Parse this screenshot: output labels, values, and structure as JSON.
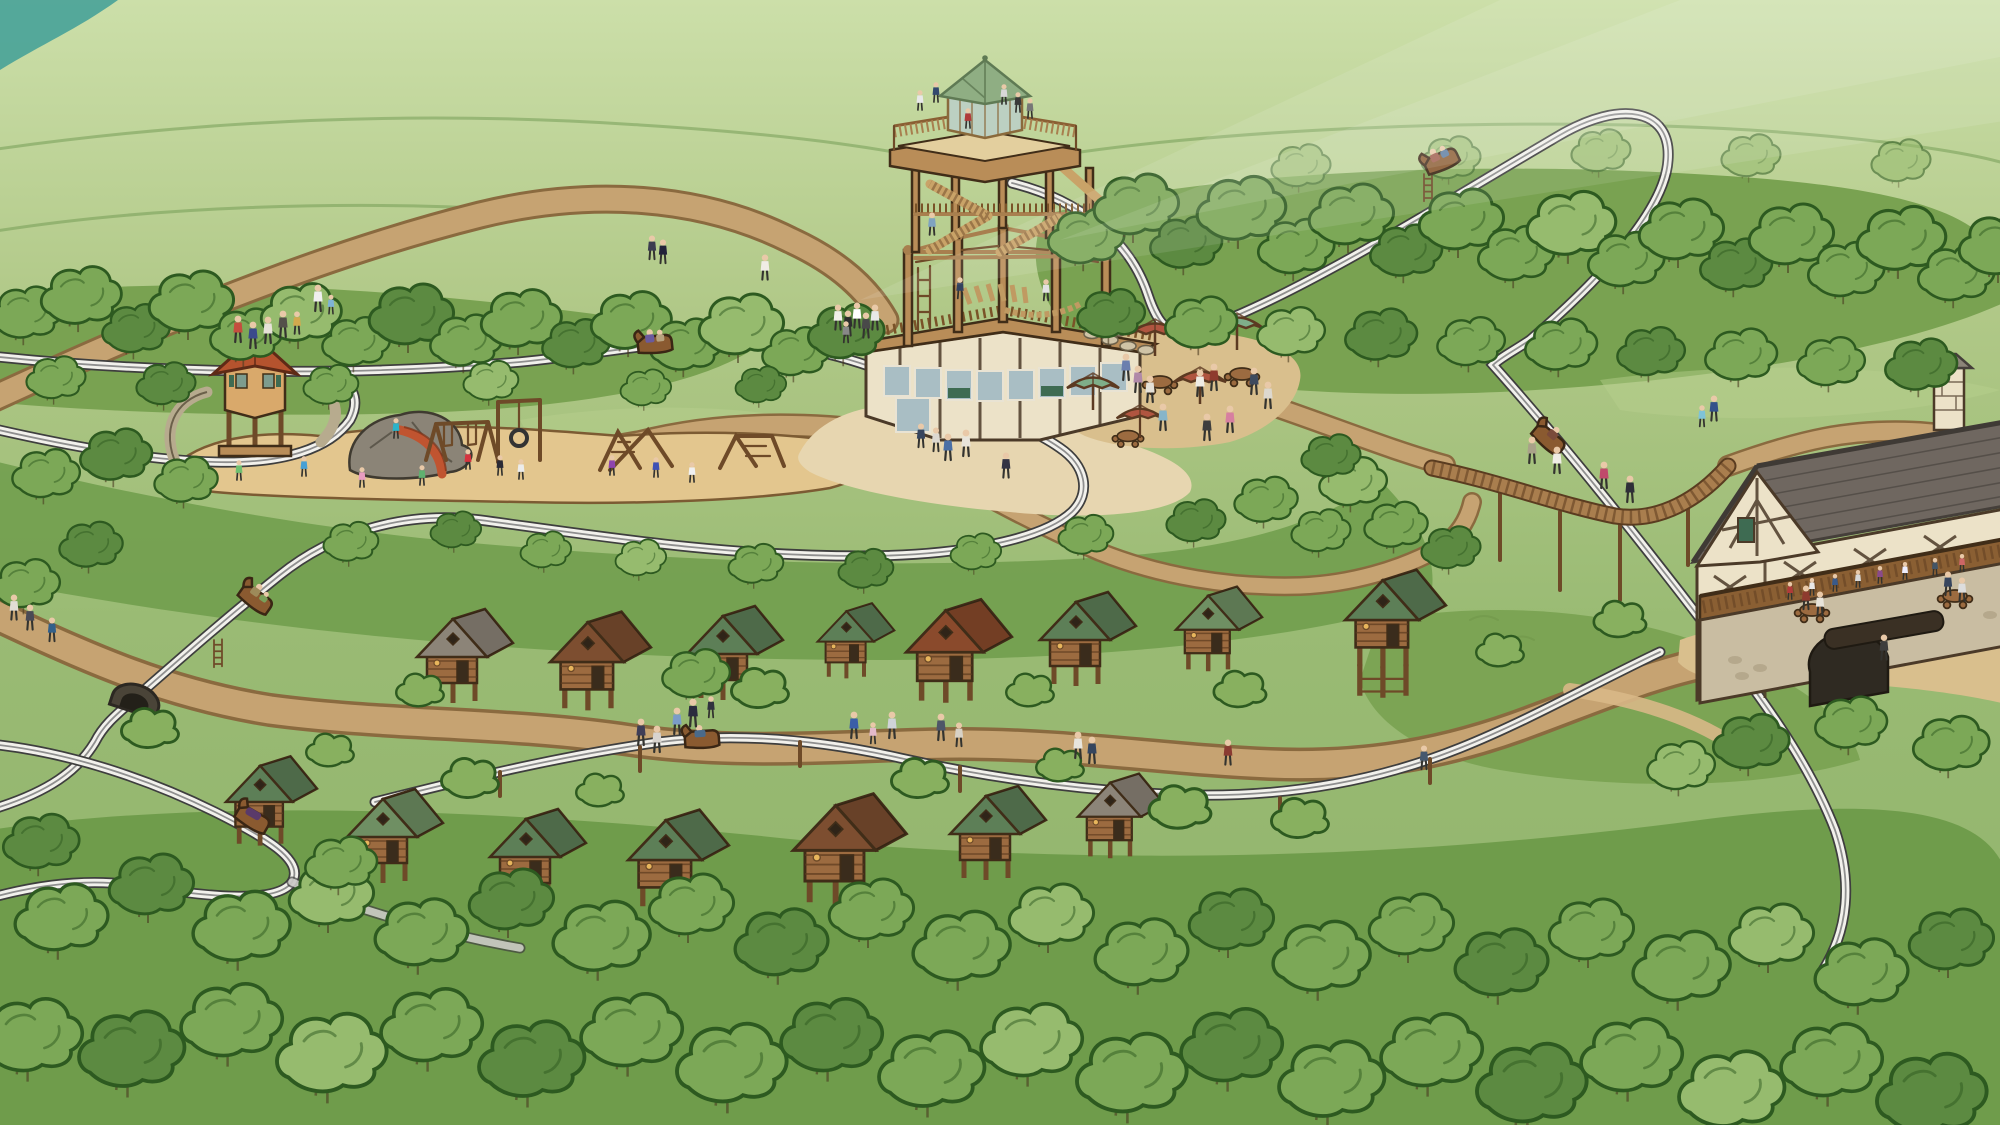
{
  "meta": {
    "title": "Illustrated forest adventure park map",
    "description": "Hand-drawn aerial map of a wooded family resort with an adventure tower, alpine coaster, stilted treehouse cabins, playground, umbrella patio and a half-timbered lodge."
  },
  "palette": {
    "bgTop": "#ccdfa9",
    "bgMid": "#b0c887",
    "bgLow": "#8fb26a",
    "teal": "#3f9f98",
    "ridge": "#6d9750",
    "forestMass": "#79a251",
    "forestFloor": "#6f9c4b",
    "grassLight": "#b7d08d",
    "tree": "#7ca857",
    "treeLight": "#96bb6e",
    "treeDark": "#5c8a41",
    "treeLine": "#2d5a20",
    "path": "#c6a372",
    "pathEdge": "#8a6a3f",
    "sand": "#e3c68e",
    "plaza": "#e7d6b0",
    "patioTan": "#d9bf8d",
    "trackDark": "#3e3e3e",
    "trackLight": "#f2f1ec",
    "trackMid": "#8f8f8f",
    "wood": "#b98d58",
    "woodMid": "#a87f4e",
    "woodDark": "#6e4a28",
    "woodLine": "#402d18",
    "logWall": "#9c6b40",
    "logLine": "#5d3a1e",
    "roofGreen": "#5d7f57",
    "roofGreen2": "#6f8f63",
    "roofBrown": "#7d4e30",
    "roofRust": "#8a4a2c",
    "roofGray": "#8c8478",
    "gazeboRoof": "#b5532e",
    "gazeboWall": "#d9a96b",
    "lodgeRoof": "#6f6760",
    "lodgeLine": "#453f3a",
    "lodgeWall": "#ece2c8",
    "timber": "#4b3a28",
    "stone": "#c9bda2",
    "umbRed": "#b05540",
    "umbGreen": "#7fae89",
    "rock": "#8b8477",
    "slide": "#c05430",
    "glass": "#a9bec4",
    "glassFrame": "#e9e3d3",
    "kioskGlass": "#bcd0c2",
    "kioskRoof": "#8fae83",
    "skin": "#e9c9a8"
  },
  "scene": {
    "tower": {
      "label": "Adventure tower with rooftop observation deck, glass kiosk and ropes course base"
    },
    "coaster": {
      "label": "Alpine coaster track winding through the forest",
      "cars": 6,
      "tunnels": 1
    },
    "playground": {
      "label": "Forest playground",
      "equipment": [
        "lookout gazebo",
        "boulder with red slide",
        "swing set",
        "tire swing",
        "climbing frames"
      ]
    },
    "cabins": {
      "label": "Stilted treehouse cabins among the trees",
      "count": 15,
      "roof_colors": [
        "green",
        "brown",
        "gray",
        "rust"
      ]
    },
    "lodge": {
      "label": "Half-timbered lodge with guest balcony, chimney and stone arcade"
    },
    "patio": {
      "label": "Umbrella patio beside the tower",
      "umbrellas": 5,
      "tables": 3
    },
    "boardwalk": {
      "label": "Elevated wooden boardwalk crossing over the coaster"
    },
    "tunnel": {
      "label": "Coaster tunnel passing under the walking trail"
    },
    "trails": {
      "label": "Dirt walking trails connecting the park"
    },
    "visitors": {
      "label": "Visitors exploring the park"
    }
  }
}
